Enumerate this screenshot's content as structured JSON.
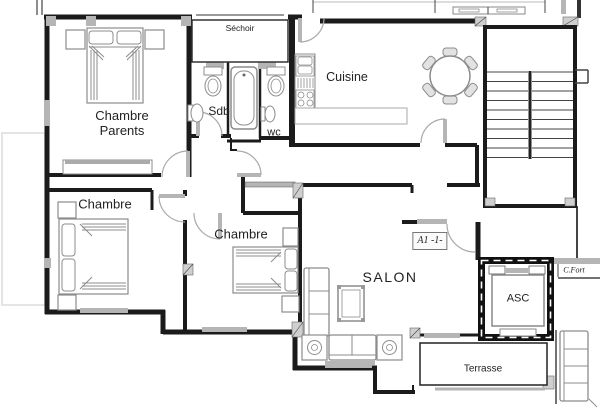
{
  "rooms": {
    "chambre_parents": {
      "label": "Chambre\nParents"
    },
    "sechoir": {
      "label": "Séchoir"
    },
    "sdb": {
      "label": "Sdb"
    },
    "wc": {
      "label": "wc"
    },
    "cuisine": {
      "label": "Cuisine"
    },
    "chambre_2": {
      "label": "Chambre"
    },
    "chambre_3": {
      "label": "Chambre"
    },
    "salon": {
      "label": "SALON"
    },
    "terrasse": {
      "label": "Terrasse"
    },
    "asc": {
      "label": "ASC"
    }
  },
  "annotations": {
    "apartment_id": "A1 -1-",
    "c_fort": "C.Fort"
  },
  "colors": {
    "wall": "#1b1b1b",
    "window_gray": "#b5b5b5",
    "furniture_stroke": "#8c8c8c",
    "door_arc": "#a9a9a9",
    "faint_outline": "#dcdcdc",
    "text": "#222222",
    "background": "#ffffff"
  }
}
